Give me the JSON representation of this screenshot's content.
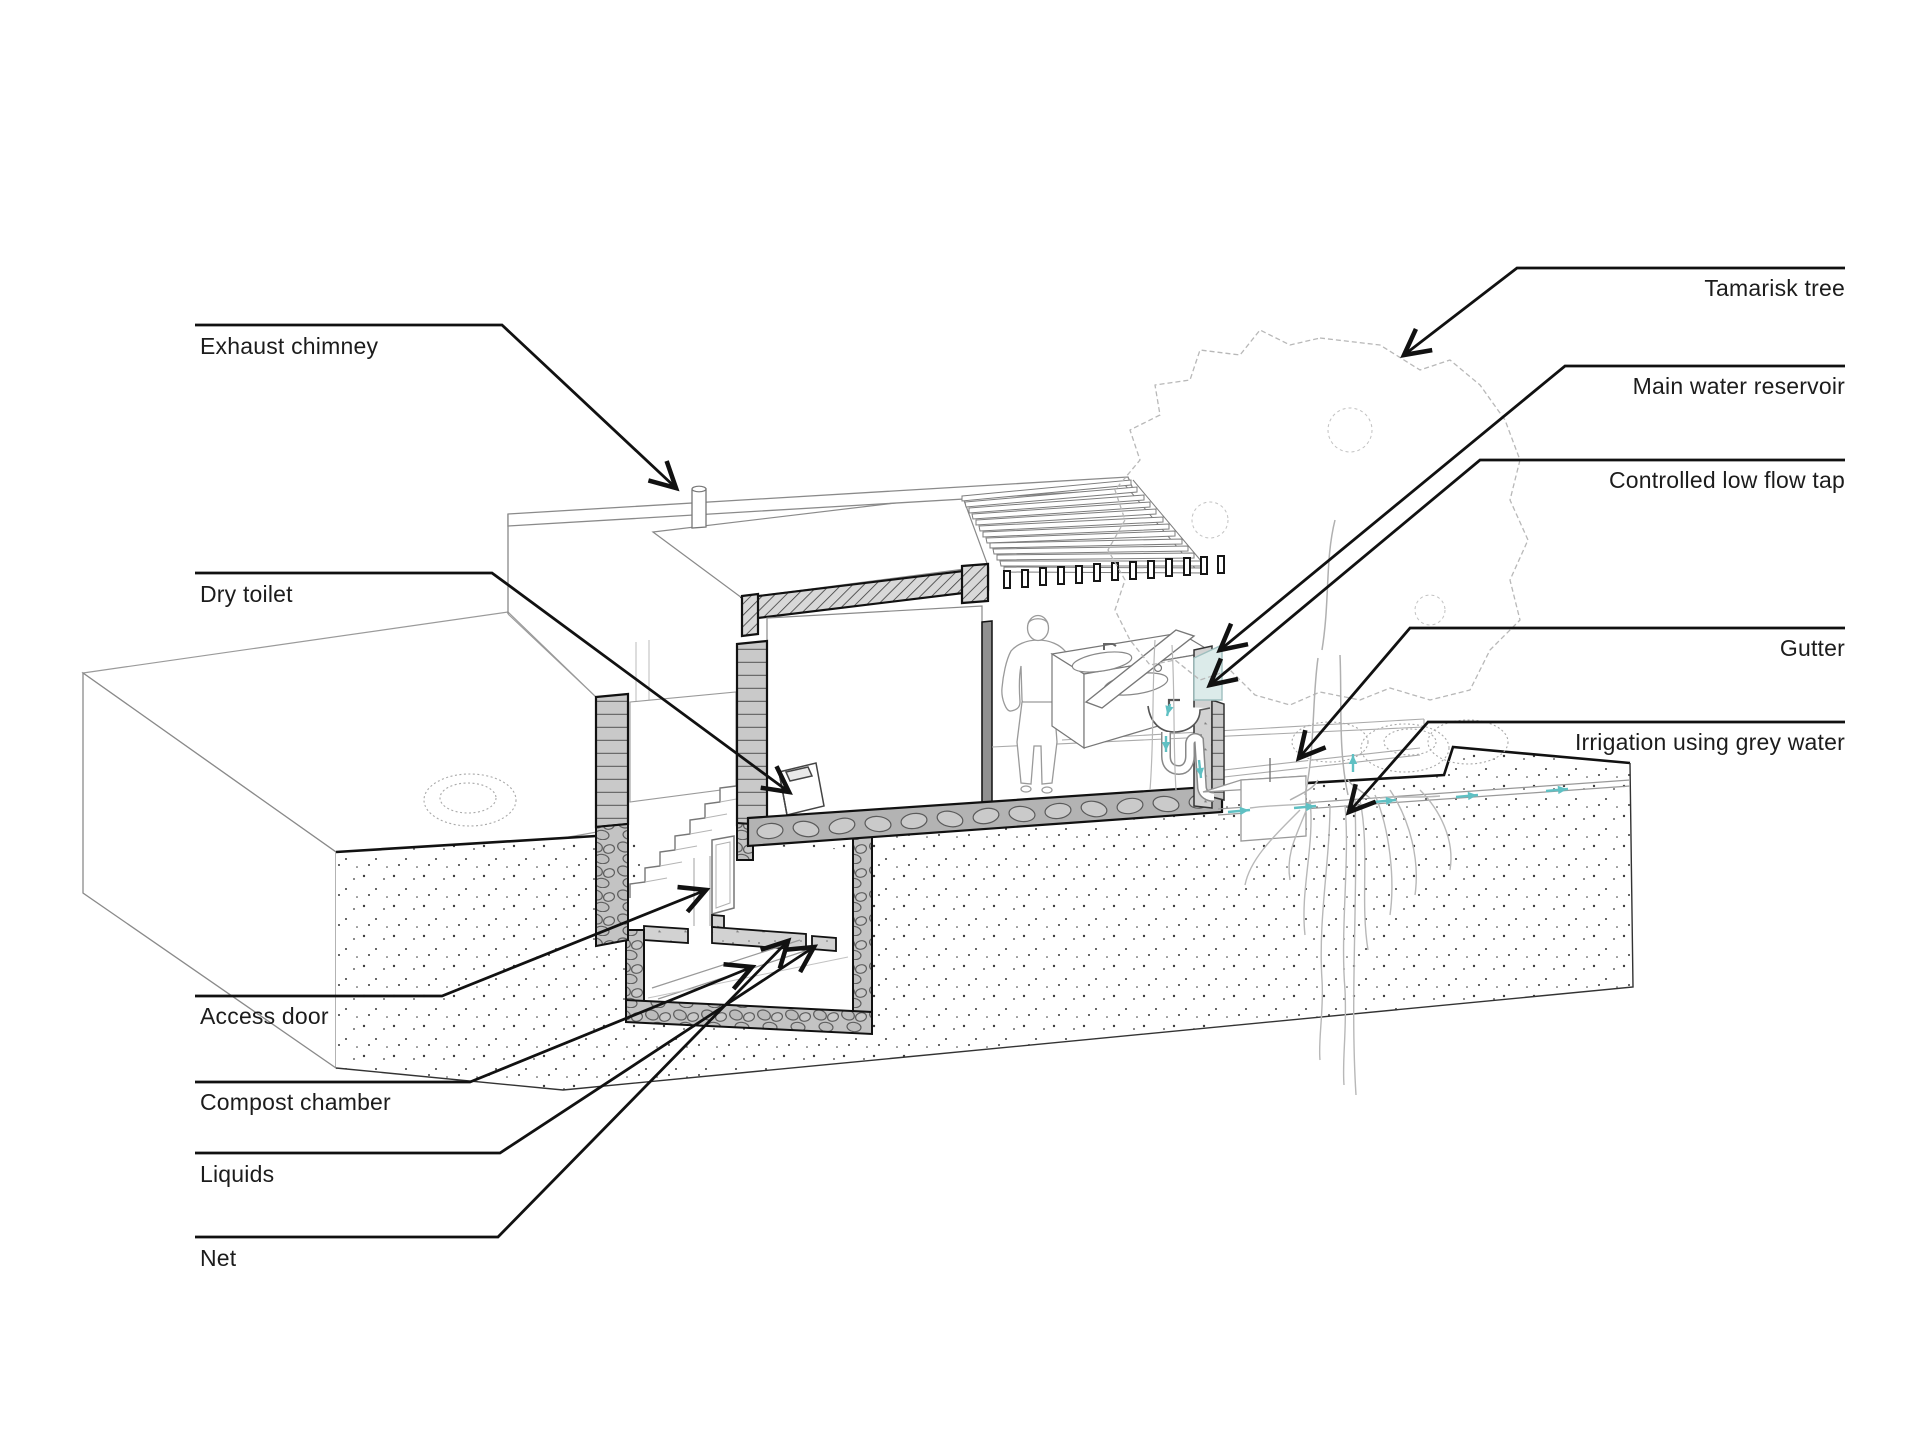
{
  "figure": {
    "kind": "architectural axonometric section diagram",
    "subject": "Dry toilet, compost chamber and grey-water irrigation system"
  },
  "labels": {
    "exhaust_chimney": {
      "text": "Exhaust chimney"
    },
    "dry_toilet": {
      "text": "Dry toilet"
    },
    "access_door": {
      "text": "Access door"
    },
    "compost_chamber": {
      "text": "Compost chamber"
    },
    "liquids": {
      "text": "Liquids"
    },
    "net": {
      "text": "Net"
    },
    "tamarisk_tree": {
      "text": "Tamarisk tree"
    },
    "main_water_reservoir": {
      "text": "Main water reservoir"
    },
    "controlled_low_flow_tap": {
      "text": "Controlled low flow tap"
    },
    "gutter": {
      "text": "Gutter"
    },
    "irrigation_grey_water": {
      "text": "Irrigation using grey water"
    }
  },
  "colors": {
    "line_black": "#1a1a1a",
    "sketch_gray": "#b8b8b8",
    "cut_fill_gray": "#c6c6c6",
    "water_accent_teal": "#5fc0c3",
    "reservoir_water": "#dcebea",
    "background": "#ffffff"
  }
}
